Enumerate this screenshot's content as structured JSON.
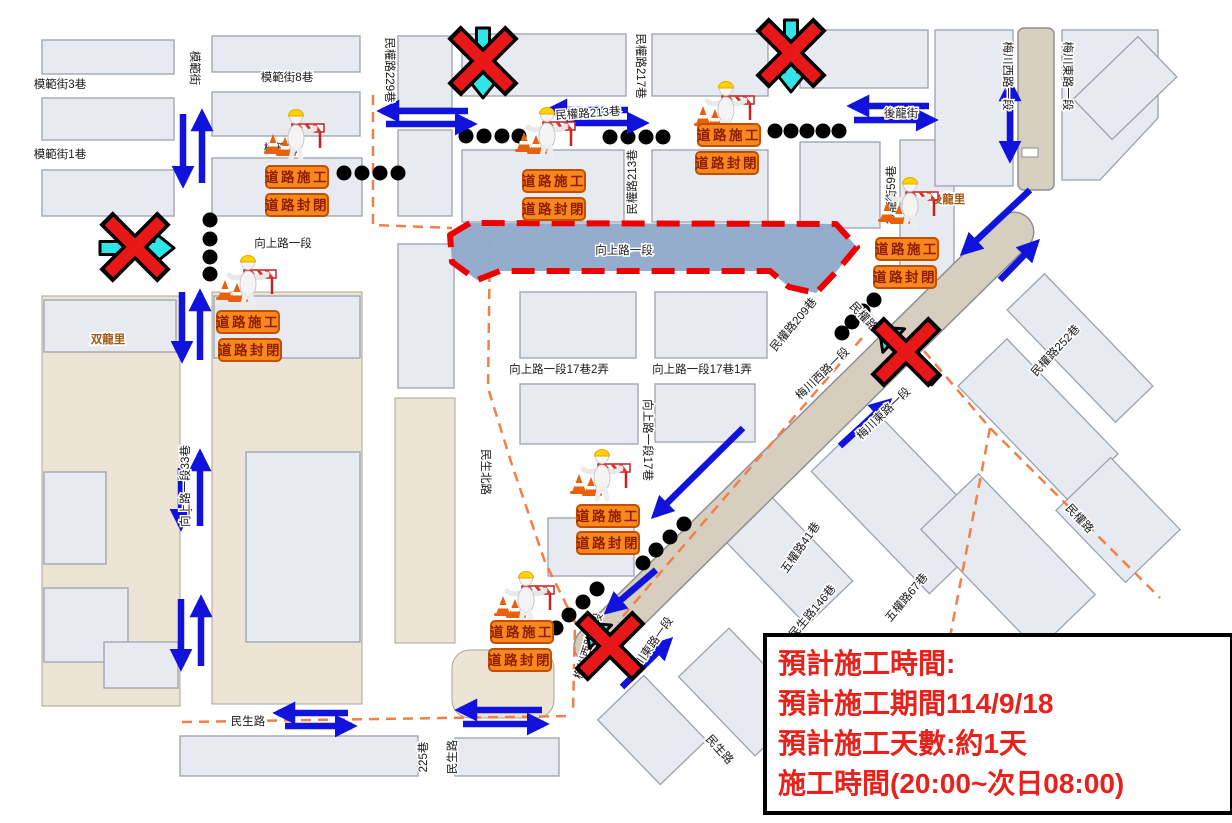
{
  "info_box": {
    "lines": [
      "預計施工時間:",
      "預計施工期間114/9/18",
      "預計施工天數:約1天",
      "施工時間(20:00~次日08:00)"
    ]
  },
  "signs": {
    "construction": "道路施工",
    "closed": "道路封閉"
  },
  "closure": {
    "label": "向上路一段",
    "points": "450,235 470,223 836,224 857,247 836,272 816,293 789,287 770,271 500,271 477,280 452,262"
  },
  "labels": [
    {
      "t": "模範街3巷",
      "x": 60,
      "y": 85,
      "r": 0
    },
    {
      "t": "模範街",
      "x": 194,
      "y": 68,
      "r": 90
    },
    {
      "t": "模範街8巷",
      "x": 287,
      "y": 78,
      "r": 0
    },
    {
      "t": "模範街",
      "x": 281,
      "y": 149,
      "r": 0
    },
    {
      "t": "模範街1巷",
      "x": 60,
      "y": 155,
      "r": 0
    },
    {
      "t": "民權路229巷",
      "x": 389,
      "y": 70,
      "r": 90
    },
    {
      "t": "民權路217巷",
      "x": 640,
      "y": 66,
      "r": 90
    },
    {
      "t": "民權路213巷",
      "x": 588,
      "y": 114,
      "r": -4
    },
    {
      "t": "民權路213巷",
      "x": 633,
      "y": 182,
      "r": -90
    },
    {
      "t": "後龍街",
      "x": 901,
      "y": 114,
      "r": 0
    },
    {
      "t": "後龍街59巷",
      "x": 892,
      "y": 195,
      "r": -90
    },
    {
      "t": "後龍里",
      "x": 948,
      "y": 200,
      "r": 0,
      "c": "brown",
      "s": 15
    },
    {
      "t": "梅川西路一段",
      "x": 1007,
      "y": 76,
      "r": 90
    },
    {
      "t": "梅川東路一段",
      "x": 1067,
      "y": 76,
      "r": 90
    },
    {
      "t": "向上路一段",
      "x": 283,
      "y": 244,
      "r": 0
    },
    {
      "t": "向上路一段",
      "x": 624,
      "y": 251,
      "r": 0
    },
    {
      "t": "双龍里",
      "x": 108,
      "y": 340,
      "r": 0,
      "c": "brown",
      "s": 15
    },
    {
      "t": "向上路一段33巷",
      "x": 186,
      "y": 486,
      "r": -90
    },
    {
      "t": "向上路一段17巷2弄",
      "x": 559,
      "y": 370,
      "r": 0
    },
    {
      "t": "向上路一段17巷1弄",
      "x": 702,
      "y": 370,
      "r": 0
    },
    {
      "t": "民權路209巷",
      "x": 794,
      "y": 325,
      "r": -50
    },
    {
      "t": "民權路",
      "x": 863,
      "y": 317,
      "r": 47
    },
    {
      "t": "民權路252巷",
      "x": 1056,
      "y": 351,
      "r": -47
    },
    {
      "t": "梅川西路一段",
      "x": 823,
      "y": 374,
      "r": -44
    },
    {
      "t": "梅川東路一段",
      "x": 884,
      "y": 414,
      "r": -44
    },
    {
      "t": "民生北路",
      "x": 485,
      "y": 472,
      "r": 90
    },
    {
      "t": "向上路一段17巷",
      "x": 647,
      "y": 440,
      "r": 90
    },
    {
      "t": "五權路41巷",
      "x": 801,
      "y": 548,
      "r": -55
    },
    {
      "t": "民生路146巷",
      "x": 813,
      "y": 612,
      "r": -50
    },
    {
      "t": "五權路67巷",
      "x": 907,
      "y": 598,
      "r": -50
    },
    {
      "t": "民權路",
      "x": 1079,
      "y": 519,
      "r": 47
    },
    {
      "t": "梅川西路一段",
      "x": 589,
      "y": 646,
      "r": -72
    },
    {
      "t": "梅川東路一段",
      "x": 651,
      "y": 647,
      "r": -55
    },
    {
      "t": "民生路",
      "x": 248,
      "y": 722,
      "r": 0
    },
    {
      "t": "225巷",
      "x": 424,
      "y": 757,
      "r": -90
    },
    {
      "t": "民生路",
      "x": 453,
      "y": 757,
      "r": -90
    },
    {
      "t": "民生路",
      "x": 719,
      "y": 750,
      "r": 48
    }
  ],
  "arrows": [
    [
      183,
      114,
      183,
      183
    ],
    [
      202,
      183,
      202,
      114
    ],
    [
      468,
      111,
      382,
      111
    ],
    [
      386,
      124,
      472,
      124
    ],
    [
      628,
      110,
      550,
      110
    ],
    [
      566,
      123,
      644,
      123
    ],
    [
      929,
      106,
      852,
      106
    ],
    [
      854,
      120,
      933,
      120
    ],
    [
      1010,
      84,
      1010,
      158,
      1
    ],
    [
      1030,
      190,
      964,
      252
    ],
    [
      1000,
      280,
      1036,
      243
    ],
    [
      840,
      446,
      888,
      402
    ],
    [
      743,
      428,
      655,
      515
    ],
    [
      656,
      570,
      608,
      611
    ],
    [
      622,
      687,
      669,
      641
    ],
    [
      182,
      292,
      182,
      358
    ],
    [
      200,
      360,
      200,
      294
    ],
    [
      181,
      468,
      181,
      526
    ],
    [
      200,
      526,
      200,
      454
    ],
    [
      181,
      599,
      181,
      666
    ],
    [
      201,
      666,
      201,
      600
    ],
    [
      348,
      713,
      278,
      713
    ],
    [
      285,
      726,
      352,
      726
    ],
    [
      542,
      710,
      460,
      710
    ],
    [
      463,
      724,
      544,
      724
    ]
  ],
  "blocked": [
    {
      "a": [
        100,
        248,
        174,
        248
      ],
      "x": 135,
      "y": 247
    },
    {
      "a": [
        483,
        28,
        483,
        98
      ],
      "x": 483,
      "y": 61
    },
    {
      "a": [
        791,
        20,
        791,
        92
      ],
      "x": 791,
      "y": 53
    },
    {
      "a": [
        936,
        380,
        879,
        327
      ],
      "x": 906,
      "y": 352
    },
    {
      "a": [
        637,
        671,
        586,
        623
      ],
      "x": 610,
      "y": 646
    }
  ],
  "sites": [
    {
      "w": [
        262,
        104
      ],
      "s1": [
        266,
        166
      ],
      "s2": [
        266,
        194
      ]
    },
    {
      "w": [
        513,
        102
      ],
      "s1": [
        523,
        170
      ],
      "s2": [
        523,
        198
      ]
    },
    {
      "w": [
        692,
        76
      ],
      "s1": [
        698,
        124
      ],
      "s2": [
        696,
        152
      ]
    },
    {
      "w": [
        876,
        172
      ],
      "s1": [
        876,
        238
      ],
      "s2": [
        874,
        266
      ]
    },
    {
      "w": [
        214,
        250
      ],
      "s1": [
        217,
        311
      ],
      "s2": [
        219,
        339
      ]
    },
    {
      "w": [
        568,
        444
      ],
      "s1": [
        577,
        505
      ],
      "s2": [
        577,
        532
      ]
    },
    {
      "w": [
        492,
        566
      ],
      "s1": [
        491,
        621
      ],
      "s2": [
        489,
        649
      ]
    }
  ],
  "dot_chains": [
    [
      [
        344,
        173
      ],
      [
        362,
        173
      ],
      [
        380,
        173
      ],
      [
        398,
        173
      ]
    ],
    [
      [
        210,
        220
      ],
      [
        210,
        239
      ],
      [
        210,
        257
      ],
      [
        210,
        274
      ]
    ],
    [
      [
        466,
        136
      ],
      [
        484,
        136
      ],
      [
        502,
        136
      ],
      [
        519,
        136
      ]
    ],
    [
      [
        610,
        137
      ],
      [
        628,
        137
      ],
      [
        646,
        137
      ],
      [
        663,
        137
      ]
    ],
    [
      [
        775,
        131
      ],
      [
        791,
        131
      ],
      [
        807,
        131
      ],
      [
        823,
        131
      ],
      [
        839,
        131
      ]
    ],
    [
      [
        874,
        300
      ],
      [
        863,
        311
      ],
      [
        852,
        322
      ],
      [
        842,
        333
      ]
    ],
    [
      [
        684,
        524
      ],
      [
        670,
        537
      ],
      [
        656,
        550
      ],
      [
        643,
        563
      ]
    ],
    [
      [
        597,
        589
      ],
      [
        583,
        602
      ],
      [
        569,
        615
      ],
      [
        556,
        628
      ]
    ]
  ],
  "boundaries": [
    [
      [
        373,
        95
      ],
      [
        373,
        225
      ],
      [
        452,
        228
      ]
    ],
    [
      [
        490,
        238
      ],
      [
        488,
        388
      ],
      [
        512,
        465
      ],
      [
        545,
        562
      ],
      [
        575,
        622
      ],
      [
        573,
        712
      ]
    ],
    [
      [
        182,
        722
      ],
      [
        573,
        716
      ]
    ],
    [
      [
        862,
        338
      ],
      [
        618,
        622
      ]
    ],
    [
      [
        913,
        338
      ],
      [
        990,
        428
      ],
      [
        1160,
        598
      ]
    ],
    [
      [
        990,
        428
      ],
      [
        950,
        637
      ]
    ]
  ],
  "colors": {
    "arrow_blue": "#1113DC",
    "blocked_red": "#E81818",
    "blocked_cyan": "#30E4E8",
    "sign_orange": "#F8871E",
    "sign_text": "#8E1E00",
    "closure_fill": "#8FA9C9",
    "closure_border": "#EE0000",
    "boundary_orange": "#F08048",
    "info_text_red": "#E8221B"
  }
}
